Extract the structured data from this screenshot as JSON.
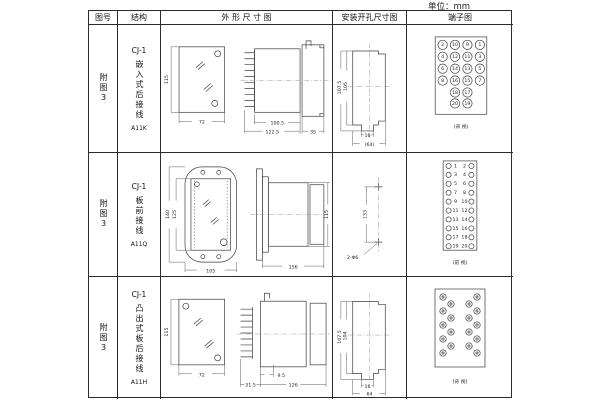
{
  "unit_label": "单位：mm",
  "table": {
    "headers": {
      "fig_no": "图号",
      "structure": "结构",
      "outline": "外 形 尺 寸 图",
      "mounting": "安装开孔尺寸图",
      "terminal": "端子图"
    }
  },
  "rows": [
    {
      "fig_no": "附图3",
      "structure": {
        "model": "CJ-1",
        "desc": "嵌入式后接线",
        "code": "A11K"
      },
      "outline_dims": {
        "height": "115",
        "width": "72",
        "body": "100.5",
        "total": "122.5",
        "rear": "35"
      },
      "mounting_dims": {
        "outer_h": "107.5",
        "inner_h": "105",
        "tab_w": "16",
        "width": "(64)"
      },
      "terminal": {
        "view": "(背 视)",
        "grid": [
          [
            "2",
            "10",
            "9",
            "1"
          ],
          [
            "4",
            "12",
            "11",
            "3"
          ],
          [
            "6",
            "14",
            "13",
            "5"
          ],
          [
            "8",
            "16",
            "15",
            "7"
          ],
          [
            "18",
            "17"
          ],
          [
            "20",
            "19"
          ]
        ]
      }
    },
    {
      "fig_no": "附图3",
      "structure": {
        "model": "CJ-1",
        "desc": "板前接线",
        "code": "A11Q"
      },
      "outline_dims": {
        "flange_h": "140",
        "inner_h": "125",
        "width": "105",
        "body_len": "156",
        "body_h": "115"
      },
      "mounting_dims": {
        "spacing": "133",
        "holes": "2-Φ6"
      },
      "terminal": {
        "view": "(前 视)",
        "left_numbers": [
          "1",
          "3",
          "5",
          "7",
          "9",
          "11",
          "13",
          "15",
          "17",
          "19"
        ],
        "right_numbers": [
          "2",
          "4",
          "6",
          "8",
          "10",
          "12",
          "14",
          "16",
          "18",
          "20"
        ]
      }
    },
    {
      "fig_no": "附图3",
      "structure": {
        "model": "CJ-1",
        "desc": "凸出式板后接线",
        "code": "A11H"
      },
      "outline_dims": {
        "height": "115",
        "width": "72",
        "pin_len": "31.5",
        "offset": "9.5",
        "body_len": "126"
      },
      "mounting_dims": {
        "outer_h": "107.5",
        "inner_h": "104",
        "tab_w": "16",
        "width": "64"
      },
      "terminal": {
        "view": "(背 视)"
      }
    }
  ]
}
